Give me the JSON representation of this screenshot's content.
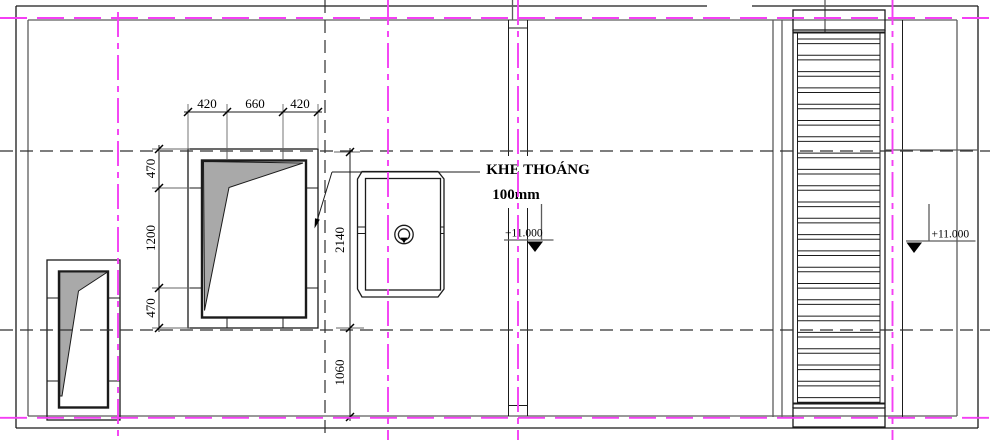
{
  "drawing": {
    "label": {
      "line1": "KHE THOÁNG",
      "line2": "100mm"
    },
    "dim_top": [
      "420",
      "660",
      "420"
    ],
    "dim_left": [
      "470",
      "1200",
      "470"
    ],
    "dim_mid": [
      "2140",
      "1060"
    ],
    "elevations": [
      {
        "value": "+11.000"
      },
      {
        "value": "+11.000"
      }
    ],
    "ladder": {
      "rung_count": 23
    },
    "colors": {
      "centerline_magenta": "#f43ff4",
      "shading_gray": "#a9a9a9",
      "line_black": "#1b1b1b",
      "line_gray": "#5c5c5c"
    }
  }
}
